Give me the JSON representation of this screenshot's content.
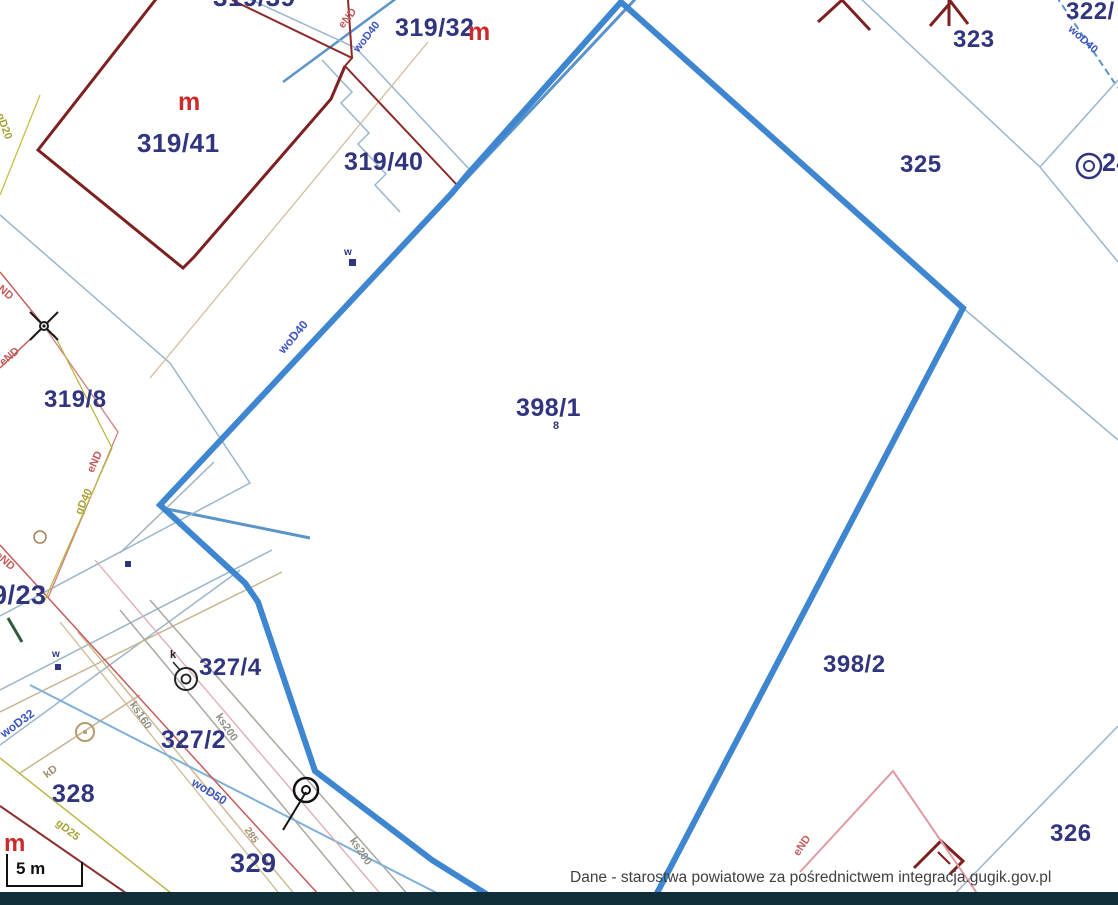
{
  "map": {
    "highlighted_parcel": "398/1",
    "attribution": "Dane - starostwa powiatowe za pośrednictwem integracja.gugik.gov.pl",
    "scale_bar_label": "5 m",
    "colors": {
      "highlight_blue": "#3f86d0",
      "parcel_label_navy": "#31347f",
      "building_dark_red": "#7e2020",
      "boundary_light_blue": "#9ab6cc",
      "water_steel_blue": "#5b94c8",
      "utility_label_blue": "#3d55c4",
      "power_red": "#c65b5b",
      "sewer_tan": "#c9b48f",
      "gas_olive": "#b9b23e",
      "bottom_bar": "#102f39"
    },
    "parcel_labels": [
      {
        "text": "319/39"
      },
      {
        "text": "319/32"
      },
      {
        "text": "319/41"
      },
      {
        "text": "319/40"
      },
      {
        "text": "319/8"
      },
      {
        "text": "323"
      },
      {
        "text": "322/"
      },
      {
        "text": "325"
      },
      {
        "text": "24"
      },
      {
        "text": "398/1"
      },
      {
        "text": "8"
      },
      {
        "text": "398/2"
      },
      {
        "text": "326"
      },
      {
        "text": "9/23"
      },
      {
        "text": "327/4"
      },
      {
        "text": "327/2"
      },
      {
        "text": "328"
      },
      {
        "text": "329"
      }
    ],
    "building_marks": [
      {
        "text": "m"
      },
      {
        "text": "m"
      },
      {
        "text": "m"
      }
    ],
    "utility_labels": [
      {
        "text": "eND"
      },
      {
        "text": "woD40"
      },
      {
        "text": "woD40"
      },
      {
        "text": "woD40"
      },
      {
        "text": "eND"
      },
      {
        "text": "eND"
      },
      {
        "text": "eND"
      },
      {
        "text": "gD40"
      },
      {
        "text": "gD20"
      },
      {
        "text": "eND"
      },
      {
        "text": "woD32"
      },
      {
        "text": "kD"
      },
      {
        "text": "gD25"
      },
      {
        "text": "ks160"
      },
      {
        "text": "ks200"
      },
      {
        "text": "ks200"
      },
      {
        "text": "285"
      },
      {
        "text": "woD50"
      },
      {
        "text": "eND"
      },
      {
        "text": "w"
      },
      {
        "text": "w"
      },
      {
        "text": "k"
      }
    ],
    "symbols": [
      "lamp-cross-icon",
      "manhole-double-circle-icon",
      "manhole-double-circle-icon",
      "well-tan-circle-icon",
      "sewer-node-circle-icon",
      "hydrant-square-icon",
      "hydrant-square-icon",
      "node-square-icon"
    ]
  }
}
